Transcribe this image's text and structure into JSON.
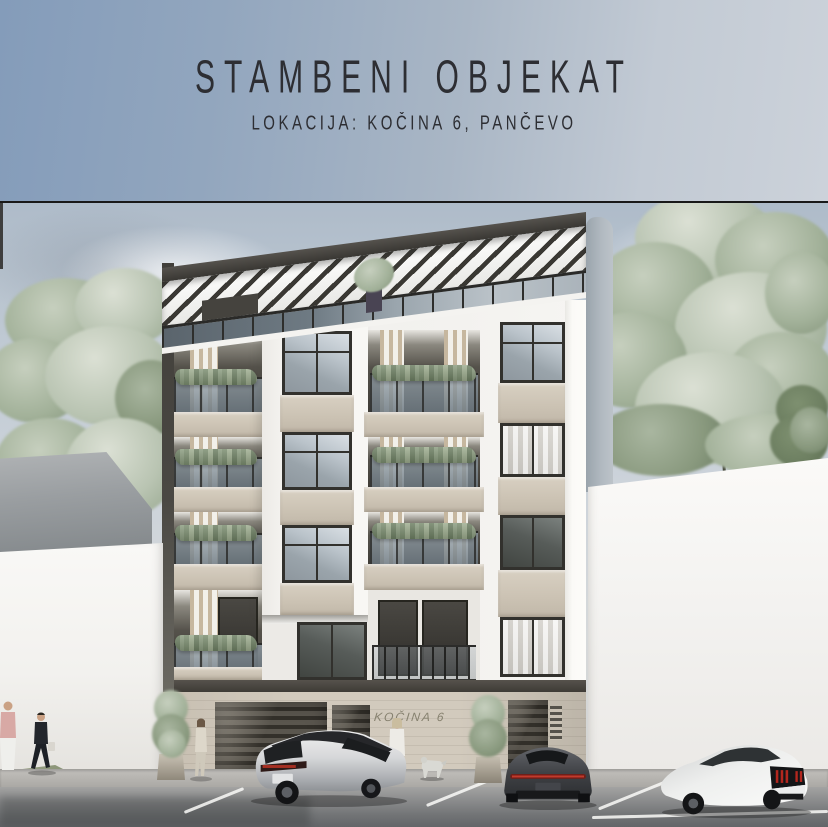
{
  "poster": {
    "title": "STAMBENI OBJEKAT",
    "subtitle": "LOKACIJA: KOČINA 6, PANČEVO"
  },
  "scene": {
    "building_sign": "KOČINA 6"
  },
  "palette": {
    "header_gradient_start": "#849cba",
    "header_gradient_end": "#ccd2da",
    "facade_white": "#f1f0ed",
    "spandrel_beige": "#cdc4b5",
    "frame_dark": "#3c3a36",
    "wood_slat": "#c6b79f",
    "glass_blue_gray": "#93a0aa",
    "greenery": "#86987b",
    "street_gray": "#8a8b8c"
  }
}
